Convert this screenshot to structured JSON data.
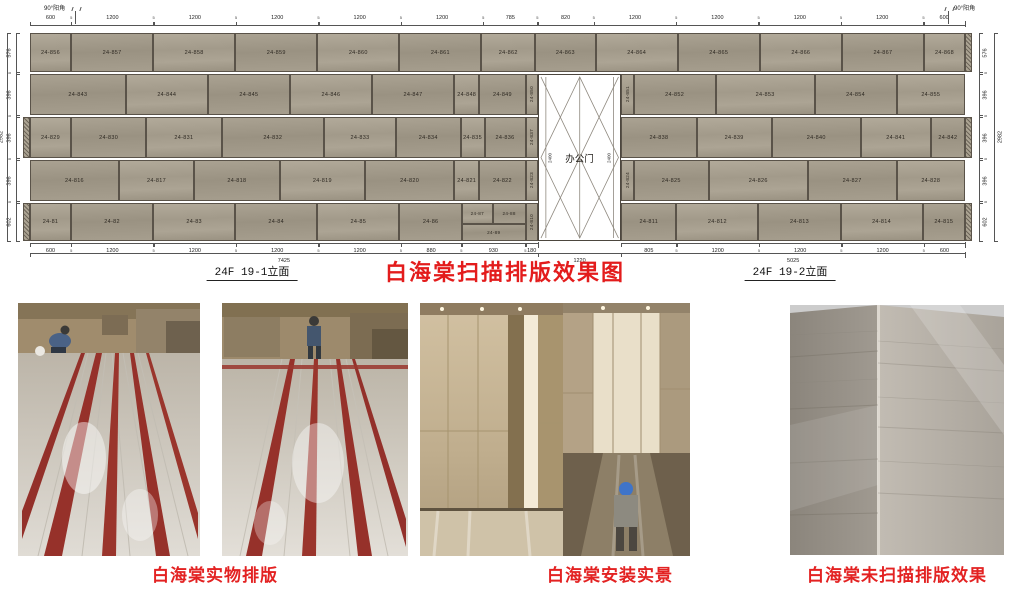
{
  "corner_labels": {
    "left": "90°阳角",
    "right": "90°阳角"
  },
  "titles": {
    "main": "白海棠扫描排版效果图",
    "section_left": "24F 19-1立面",
    "section_right": "24F 19-2立面"
  },
  "door": {
    "label": "办公门",
    "height_dim": "2400",
    "width_dim": "1220"
  },
  "elevation": {
    "walls": {
      "left_mm": 7425,
      "door_mm": 1220,
      "right_mm": 5025,
      "total_mm": 13670
    },
    "row_heights_px": [
      39,
      41,
      41,
      41,
      38
    ],
    "rows": [
      {
        "cells": [
          [
            "24-856",
            600
          ],
          [
            "24-857",
            1200
          ],
          [
            "24-858",
            1200
          ],
          [
            "24-859",
            1200
          ],
          [
            "24-860",
            1200
          ],
          [
            "24-861",
            1200
          ],
          [
            "24-862",
            785
          ],
          [
            "24-863",
            885
          ],
          [
            "24-864",
            1200
          ],
          [
            "24-865",
            1200
          ],
          [
            "24-866",
            1200
          ],
          [
            "24-867",
            1200
          ],
          [
            "24-868",
            600
          ]
        ]
      },
      {
        "left": [
          [
            "24-843",
            1400
          ],
          [
            "24-844",
            1200
          ],
          [
            "24-845",
            1200
          ],
          [
            "24-846",
            1200
          ],
          [
            "24-847",
            1200
          ],
          [
            "24-848",
            370
          ],
          [
            "24-849",
            675
          ],
          [
            "24-850",
            180,
            "v"
          ]
        ],
        "right": [
          [
            "24-851",
            180,
            "v"
          ],
          [
            "24-852",
            1200
          ],
          [
            "24-853",
            1445
          ],
          [
            "24-854",
            1200
          ],
          [
            "24-855",
            1000
          ]
        ]
      },
      {
        "left": [
          [
            "24-829",
            600
          ],
          [
            "24-830",
            1100
          ],
          [
            "24-831",
            1100
          ],
          [
            "24-832",
            1500
          ],
          [
            "24-833",
            1050
          ],
          [
            "24-834",
            945
          ],
          [
            "24-835",
            350
          ],
          [
            "24-836",
            600
          ],
          [
            "24-837",
            180,
            "v"
          ]
        ],
        "right": [
          [
            "24-838",
            1100
          ],
          [
            "24-839",
            1100
          ],
          [
            "24-840",
            1300
          ],
          [
            "24-841",
            1025
          ],
          [
            "24-842",
            500
          ]
        ]
      },
      {
        "left": [
          [
            "24-816",
            1300
          ],
          [
            "24-817",
            1100
          ],
          [
            "24-818",
            1250
          ],
          [
            "24-819",
            1250
          ],
          [
            "24-820",
            1300
          ],
          [
            "24-821",
            370
          ],
          [
            "24-822",
            675
          ],
          [
            "24-823",
            180,
            "v"
          ]
        ],
        "right": [
          [
            "24-824",
            180,
            "v"
          ],
          [
            "24-825",
            1100
          ],
          [
            "24-826",
            1445
          ],
          [
            "24-827",
            1300
          ],
          [
            "24-828",
            1000
          ]
        ]
      },
      {
        "left": [
          [
            "24-81",
            600
          ],
          [
            "24-82",
            1200
          ],
          [
            "24-83",
            1200
          ],
          [
            "24-84",
            1200
          ],
          [
            "24-85",
            1200
          ],
          [
            "24-86",
            915
          ],
          [
            "STACK",
            930
          ],
          [
            "24-810",
            180,
            "v"
          ]
        ],
        "right": [
          [
            "24-811",
            805
          ],
          [
            "24-812",
            1200
          ],
          [
            "24-813",
            1200
          ],
          [
            "24-814",
            1200
          ],
          [
            "24-815",
            620
          ]
        ],
        "stack": {
          "total": 930,
          "top": [
            [
              "24-87",
              450
            ],
            [
              "24-88",
              480
            ]
          ],
          "bottom": [
            [
              "24-89",
              930
            ]
          ]
        }
      }
    ],
    "top_dims": [
      "600",
      "5",
      "1200",
      "5",
      "1200",
      "5",
      "1200",
      "5",
      "1200",
      "5",
      "1200",
      "5",
      "785",
      "5",
      "820",
      "5",
      "1200",
      "5",
      "1200",
      "5",
      "1200",
      "5",
      "1200",
      "5",
      "600"
    ],
    "bottom_dims_left": [
      "600",
      "5",
      "1200",
      "5",
      "1200",
      "5",
      "1200",
      "5",
      "1200",
      "5",
      "880",
      "5",
      "930",
      "5",
      "180"
    ],
    "bottom_dims_right": [
      "805",
      "5",
      "1200",
      "5",
      "1200",
      "5",
      "1200",
      "5",
      "600"
    ],
    "bottom_totals": [
      "7425",
      "1220",
      "5025"
    ],
    "side_dims": [
      "576",
      "5",
      "396",
      "5",
      "396",
      "5",
      "396",
      "5",
      "602"
    ],
    "side_total": "2982"
  },
  "captions": [
    {
      "text": "白海棠实物排版"
    },
    {
      "text": "白海棠安装实景"
    },
    {
      "text": "白海棠未扫描排版效果"
    }
  ],
  "accent_colors": {
    "title_red": "#e31c1c",
    "stone": "#a69e8e"
  }
}
